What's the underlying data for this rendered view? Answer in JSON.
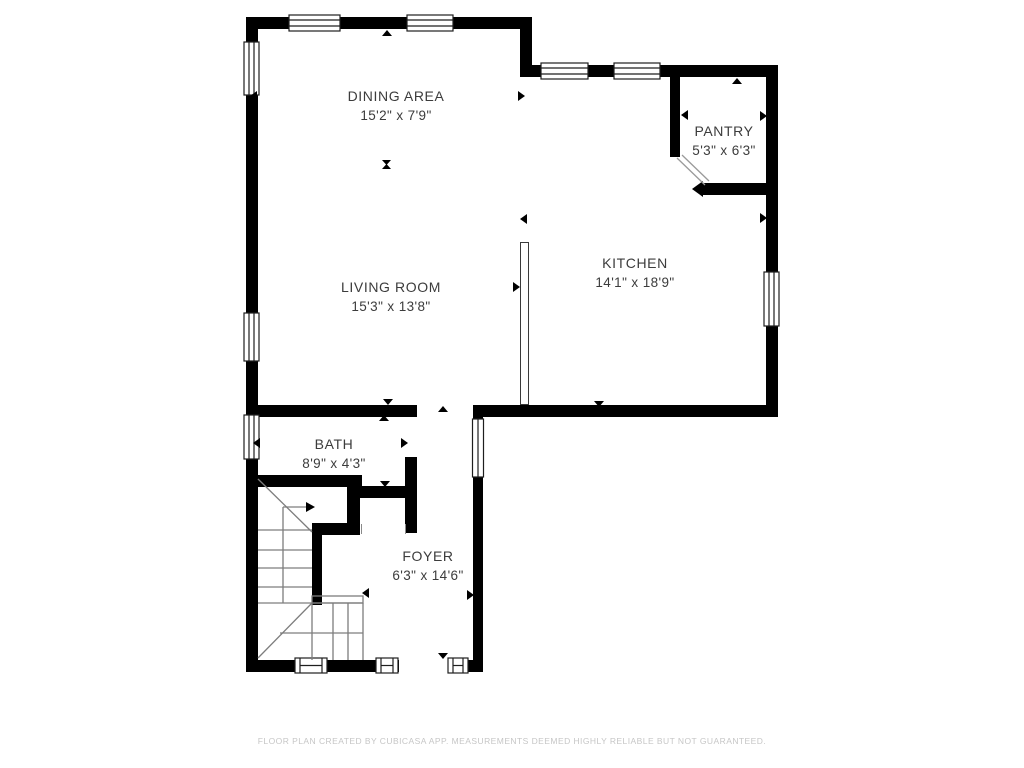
{
  "rooms": {
    "dining": {
      "label": "DINING AREA",
      "dimensions": "15'2\" x 7'9\""
    },
    "pantry": {
      "label": "PANTRY",
      "dimensions": "5'3\" x 6'3\""
    },
    "kitchen": {
      "label": "KITCHEN",
      "dimensions": "14'1\" x 18'9\""
    },
    "living": {
      "label": "LIVING ROOM",
      "dimensions": "15'3\" x 13'8\""
    },
    "bath": {
      "label": "BATH",
      "dimensions": "8'9\" x 4'3\""
    },
    "foyer": {
      "label": "FOYER",
      "dimensions": "6'3\" x 14'6\""
    }
  },
  "footer": {
    "disclaimer": "FLOOR PLAN CREATED BY CUBICASA APP. MEASUREMENTS DEEMED HIGHLY RELIABLE BUT NOT GUARANTEED."
  },
  "colors": {
    "background": "#ffffff",
    "wall": "#000000",
    "stair_line": "#7d7d7d",
    "label_text": "#3c3c3c",
    "footer_text": "#c6c6c6"
  }
}
